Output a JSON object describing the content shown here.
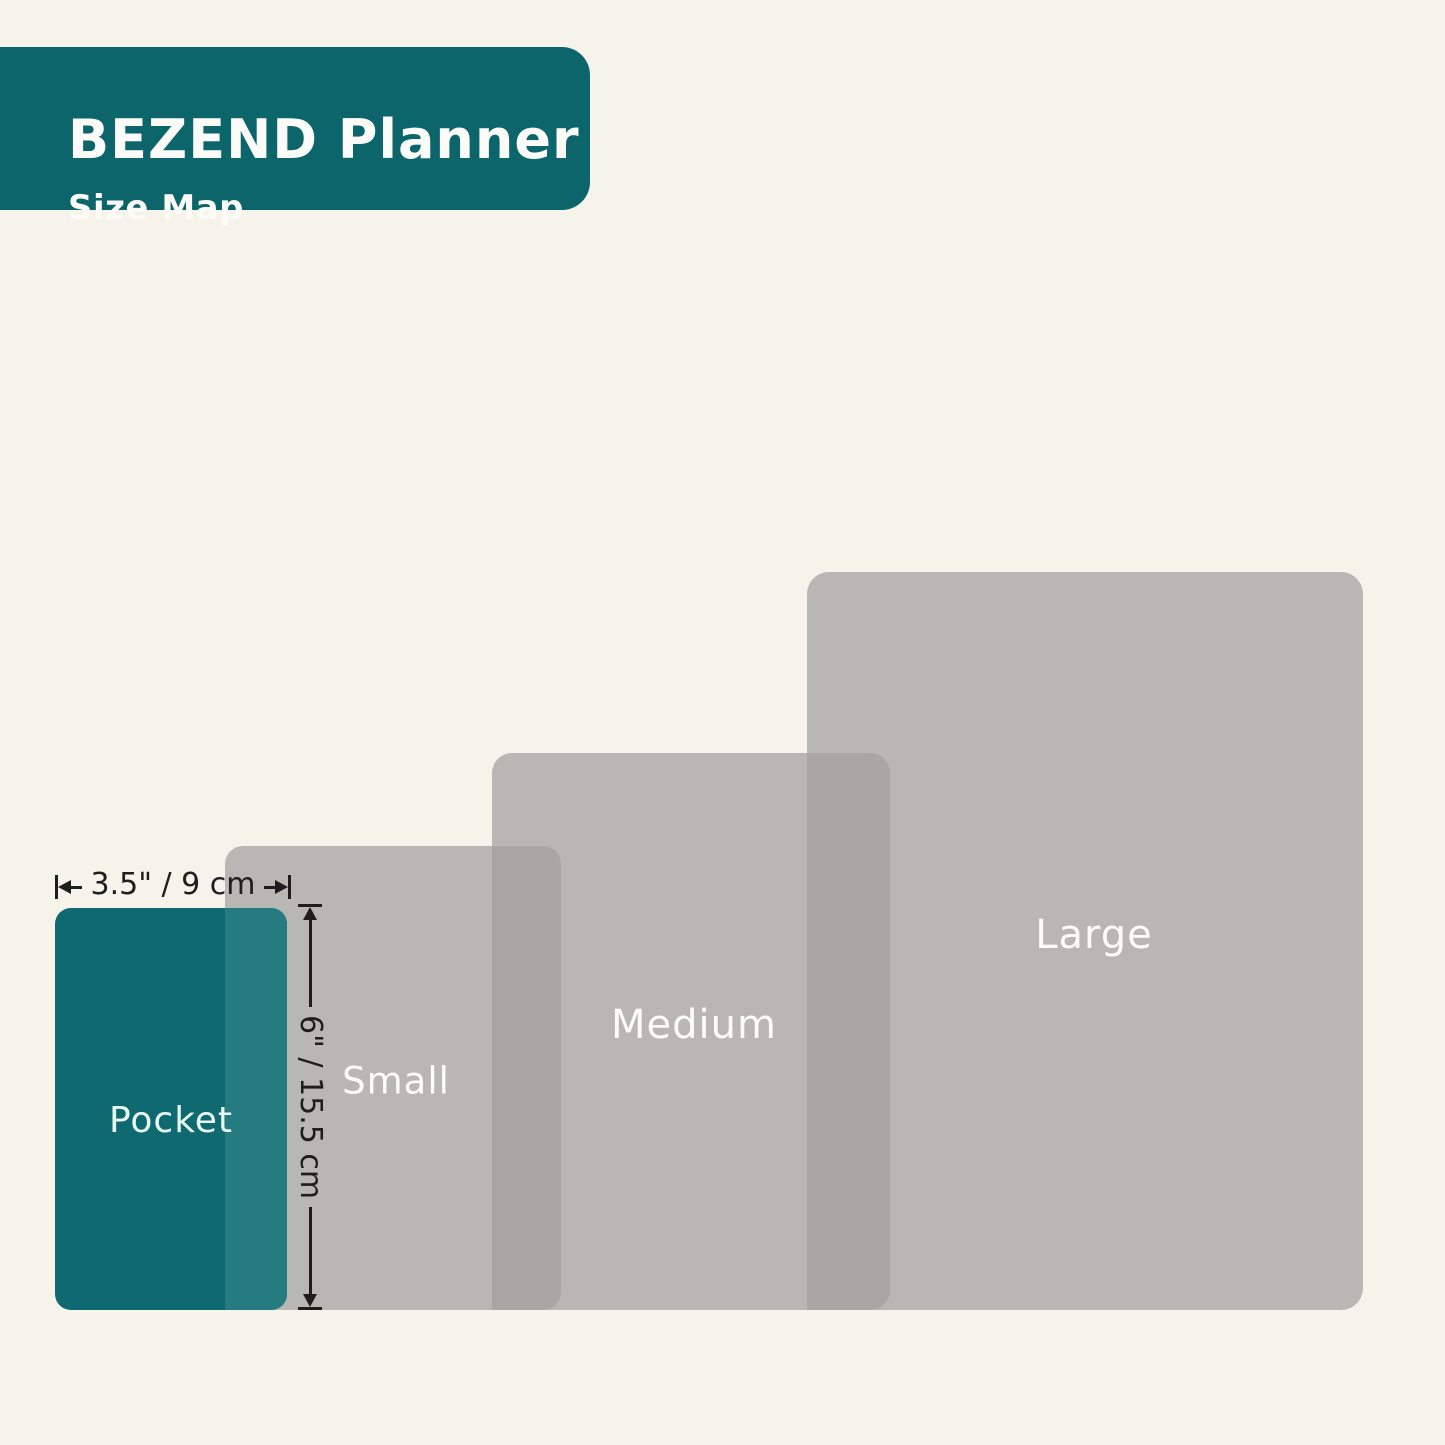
{
  "header": {
    "title": "BEZEND Planner",
    "subtitle": "Size Map"
  },
  "planners": {
    "pocket": {
      "label": "Pocket"
    },
    "small": {
      "label": "Small"
    },
    "medium": {
      "label": "Medium"
    },
    "large": {
      "label": "Large"
    }
  },
  "dimensions": {
    "width_label": "3.5\" / 9 cm",
    "height_label": "6\" / 15.5 cm"
  },
  "colors": {
    "background": "#f6f3ea",
    "header_bg": "#0d656c",
    "header_text": "#fbfcf7",
    "planner_teal": "#0e6a70",
    "planner_teal_overlap": "#257b7f",
    "planner_gray": "#b9b7b4",
    "planner_gray_overlap": "#a9a7a4",
    "label_text": "#fcfcfa",
    "pocket_label_text": "#e9f9f1",
    "annotation": "#1e1e1e"
  }
}
